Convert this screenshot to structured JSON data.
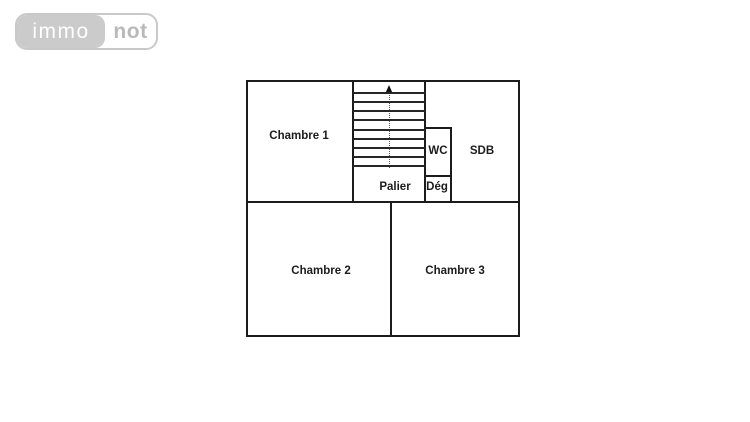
{
  "logo": {
    "part1": "immo",
    "part2": "not"
  },
  "plan": {
    "rooms": {
      "chambre1": "Chambre 1",
      "wc": "WC",
      "sdb": "SDB",
      "palier": "Palier",
      "deg": "Dég",
      "chambre2": "Chambre 2",
      "chambre3": "Chambre 3"
    },
    "stairs": {
      "step_count": 9,
      "direction": "up"
    }
  },
  "colors": {
    "wall": "#1c1c1c",
    "label_text": "#1c1c1c",
    "logo_pill": "#cbcbcb",
    "logo_border": "#c9c9c9",
    "logo_text_immo": "#ffffff",
    "logo_text_not": "#b9b9b9",
    "background": "#ffffff"
  }
}
